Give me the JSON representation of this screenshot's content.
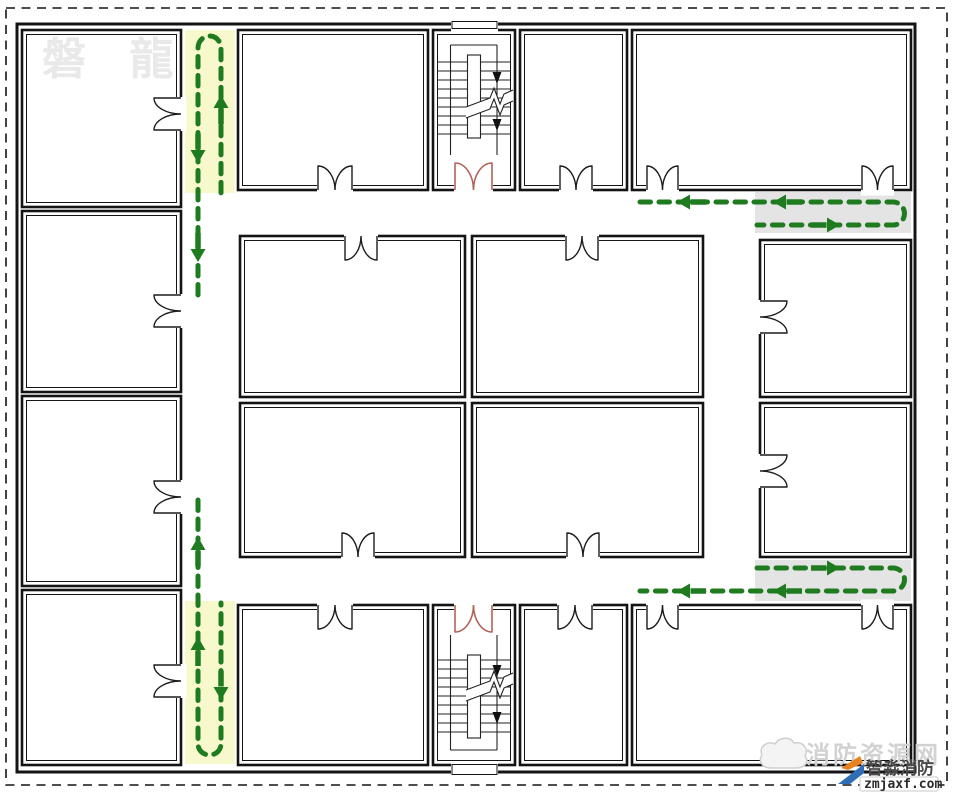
{
  "title": "fire-evacuation-floor-plan",
  "watermarks": {
    "top_left": "磐 龍",
    "site_name": "消防资源网",
    "brand": "智淼消防",
    "domain": "zmjaxf.com"
  },
  "colors": {
    "wall": "#141414",
    "route": "#1e7b1f",
    "corridor_yellow": "#f7f8cc",
    "corridor_gray": "#e4e4e4",
    "door_red": "#b2635a",
    "logo_blue": "#2f6db5",
    "logo_orange": "#e8821e",
    "background": "#ffffff"
  },
  "plan": {
    "canvas": {
      "w": 955,
      "h": 798
    },
    "dashed_border": {
      "x": 6,
      "y": 8,
      "w": 941,
      "h": 777
    },
    "outer_wall": {
      "x": 17,
      "y": 24,
      "w": 898,
      "h": 748
    },
    "highlights": [
      {
        "name": "corridor-highlight-left-top",
        "color": "corridor_yellow",
        "x": 185,
        "y": 30,
        "w": 50,
        "h": 163
      },
      {
        "name": "corridor-highlight-left-bottom",
        "color": "corridor_yellow",
        "x": 185,
        "y": 601,
        "w": 50,
        "h": 163
      },
      {
        "name": "corridor-highlight-right-top",
        "color": "corridor_gray",
        "x": 755,
        "y": 192,
        "w": 156,
        "h": 41
      },
      {
        "name": "corridor-highlight-right-bottom",
        "color": "corridor_gray",
        "x": 755,
        "y": 560,
        "w": 156,
        "h": 41
      }
    ],
    "rooms": [
      {
        "name": "room-left-1",
        "x": 22,
        "y": 30,
        "w": 159,
        "h": 177
      },
      {
        "name": "room-left-2",
        "x": 22,
        "y": 211,
        "w": 159,
        "h": 181
      },
      {
        "name": "room-left-3",
        "x": 22,
        "y": 396,
        "w": 159,
        "h": 190
      },
      {
        "name": "room-left-4",
        "x": 22,
        "y": 590,
        "w": 159,
        "h": 175
      },
      {
        "name": "room-top-1",
        "x": 238,
        "y": 30,
        "w": 190,
        "h": 160
      },
      {
        "name": "stairwell-top",
        "x": 433,
        "y": 30,
        "w": 82,
        "h": 160
      },
      {
        "name": "room-top-2",
        "x": 520,
        "y": 30,
        "w": 107,
        "h": 160
      },
      {
        "name": "room-top-right",
        "x": 632,
        "y": 30,
        "w": 279,
        "h": 160
      },
      {
        "name": "room-center-1",
        "x": 240,
        "y": 236,
        "w": 225,
        "h": 161
      },
      {
        "name": "room-center-2",
        "x": 472,
        "y": 236,
        "w": 231,
        "h": 161
      },
      {
        "name": "room-center-3",
        "x": 240,
        "y": 403,
        "w": 225,
        "h": 154
      },
      {
        "name": "room-center-4",
        "x": 472,
        "y": 403,
        "w": 231,
        "h": 154
      },
      {
        "name": "room-right-1",
        "x": 760,
        "y": 240,
        "w": 151,
        "h": 157
      },
      {
        "name": "room-right-2",
        "x": 760,
        "y": 403,
        "w": 151,
        "h": 154
      },
      {
        "name": "room-bottom-1",
        "x": 238,
        "y": 605,
        "w": 190,
        "h": 160
      },
      {
        "name": "stairwell-bottom",
        "x": 433,
        "y": 605,
        "w": 82,
        "h": 160
      },
      {
        "name": "room-bottom-2",
        "x": 520,
        "y": 605,
        "w": 107,
        "h": 160
      },
      {
        "name": "room-bottom-right",
        "x": 632,
        "y": 605,
        "w": 279,
        "h": 160
      }
    ],
    "exits": [
      {
        "name": "exterior-exit-top",
        "x": 451,
        "y": 19,
        "w": 47,
        "h": 13
      },
      {
        "name": "exterior-exit-bottom",
        "x": 451,
        "y": 762,
        "w": 47,
        "h": 16
      }
    ],
    "stairs": [
      {
        "name": "stair-top",
        "treads": {
          "x1": 437,
          "x2": 511,
          "y0": 62,
          "step": 9,
          "n": 9
        },
        "rails": {
          "xl": 450.5,
          "xr": 497,
          "y1": 45,
          "y2": 155,
          "conn": 45
        },
        "stringer": {
          "x": 467.5,
          "y": 55,
          "w": 13,
          "h": 83
        },
        "break1": [
          [
            466,
            107
          ],
          [
            490,
            98
          ],
          [
            494,
            88
          ],
          [
            500,
            104
          ],
          [
            504,
            94
          ],
          [
            513,
            90
          ]
        ],
        "break2": [
          [
            466,
            118
          ],
          [
            490,
            109
          ],
          [
            494,
            99
          ],
          [
            500,
            115
          ],
          [
            504,
            105
          ],
          [
            513,
            101
          ]
        ],
        "arrows": [
          {
            "x": 497,
            "y": 84
          },
          {
            "x": 497,
            "y": 131
          }
        ]
      },
      {
        "name": "stair-bottom",
        "treads": {
          "x1": 437,
          "x2": 511,
          "y0": 660,
          "step": 9,
          "n": 9
        },
        "rails": {
          "xl": 450.5,
          "xr": 497,
          "y1": 635,
          "y2": 750,
          "conn": 750
        },
        "stringer": {
          "x": 467.5,
          "y": 655,
          "w": 13,
          "h": 83
        },
        "break1": [
          [
            466,
            690
          ],
          [
            490,
            681
          ],
          [
            494,
            671
          ],
          [
            500,
            687
          ],
          [
            504,
            677
          ],
          [
            513,
            673
          ]
        ],
        "break2": [
          [
            466,
            701
          ],
          [
            490,
            692
          ],
          [
            494,
            682
          ],
          [
            500,
            698
          ],
          [
            504,
            688
          ],
          [
            513,
            684
          ]
        ],
        "arrows": [
          {
            "x": 497,
            "y": 677
          },
          {
            "x": 497,
            "y": 724
          }
        ]
      }
    ],
    "doors": [
      {
        "name": "door-room-left-1",
        "orient": "v",
        "wall": 181,
        "a": 98,
        "b": 130,
        "swing": "left"
      },
      {
        "name": "door-room-left-2",
        "orient": "v",
        "wall": 181,
        "a": 295,
        "b": 327,
        "swing": "left"
      },
      {
        "name": "door-room-left-3",
        "orient": "v",
        "wall": 181,
        "a": 481,
        "b": 513,
        "swing": "left"
      },
      {
        "name": "door-room-left-4",
        "orient": "v",
        "wall": 181,
        "a": 665,
        "b": 697,
        "swing": "left"
      },
      {
        "name": "door-room-top-1",
        "orient": "h",
        "wall": 190,
        "a": 318,
        "b": 352,
        "swing": "up"
      },
      {
        "name": "door-stairwell-top",
        "orient": "h",
        "wall": 190,
        "a": 455,
        "b": 492,
        "swing": "up",
        "red": true
      },
      {
        "name": "door-room-top-2",
        "orient": "h",
        "wall": 190,
        "a": 560,
        "b": 592,
        "swing": "up"
      },
      {
        "name": "door-room-top-right-a",
        "orient": "h",
        "wall": 190,
        "a": 647,
        "b": 678,
        "swing": "up"
      },
      {
        "name": "door-room-top-right-b",
        "orient": "h",
        "wall": 190,
        "a": 862,
        "b": 893,
        "swing": "up"
      },
      {
        "name": "door-room-center-1",
        "orient": "h",
        "wall": 236,
        "a": 345,
        "b": 377,
        "swing": "down"
      },
      {
        "name": "door-room-center-2",
        "orient": "h",
        "wall": 236,
        "a": 566,
        "b": 598,
        "swing": "down"
      },
      {
        "name": "door-room-center-3",
        "orient": "h",
        "wall": 557,
        "a": 342,
        "b": 374,
        "swing": "up"
      },
      {
        "name": "door-room-center-4",
        "orient": "h",
        "wall": 557,
        "a": 567,
        "b": 599,
        "swing": "up"
      },
      {
        "name": "door-room-right-1",
        "orient": "v",
        "wall": 760,
        "a": 301,
        "b": 333,
        "swing": "right"
      },
      {
        "name": "door-room-right-2",
        "orient": "v",
        "wall": 760,
        "a": 455,
        "b": 487,
        "swing": "right"
      },
      {
        "name": "door-room-bottom-1",
        "orient": "h",
        "wall": 605,
        "a": 318,
        "b": 352,
        "swing": "down"
      },
      {
        "name": "door-stairwell-bottom",
        "orient": "h",
        "wall": 605,
        "a": 455,
        "b": 492,
        "swing": "down",
        "red": true
      },
      {
        "name": "door-room-bottom-2",
        "orient": "h",
        "wall": 605,
        "a": 558,
        "b": 592,
        "swing": "down"
      },
      {
        "name": "door-room-bottom-right-a",
        "orient": "h",
        "wall": 605,
        "a": 647,
        "b": 678,
        "swing": "down"
      },
      {
        "name": "door-room-bottom-right-b",
        "orient": "h",
        "wall": 605,
        "a": 862,
        "b": 893,
        "swing": "down"
      }
    ],
    "routes": [
      {
        "name": "evacuation-route-left-corridor-top",
        "d": "M 198 295 L 198 48 A 11.5 12 0 0 1 221 48 L 221 193"
      },
      {
        "name": "evacuation-route-left-corridor-bottom",
        "d": "M 198 500 L 198 744 A 11.5 11 0 0 0 221 744 L 221 603"
      },
      {
        "name": "evacuation-route-right-corridor-top",
        "d": "M 640 202 L 893 202 A 11.5 11.5 0 0 1 893 225 L 757 225"
      },
      {
        "name": "evacuation-route-right-corridor-bottom",
        "d": "M 757 568 L 893 568 A 11.5 11.5 0 0 1 893 591 L 640 591"
      }
    ],
    "route_arrows": [
      {
        "x": 198,
        "y": 163,
        "d": "down"
      },
      {
        "x": 221,
        "y": 95,
        "d": "up"
      },
      {
        "x": 198,
        "y": 262,
        "d": "down"
      },
      {
        "x": 198,
        "y": 537,
        "d": "up"
      },
      {
        "x": 198,
        "y": 637,
        "d": "up"
      },
      {
        "x": 221,
        "y": 700,
        "d": "down"
      },
      {
        "x": 677,
        "y": 202,
        "d": "left"
      },
      {
        "x": 773,
        "y": 202,
        "d": "left"
      },
      {
        "x": 840,
        "y": 225,
        "d": "right"
      },
      {
        "x": 840,
        "y": 568,
        "d": "right"
      },
      {
        "x": 677,
        "y": 591,
        "d": "left"
      },
      {
        "x": 773,
        "y": 591,
        "d": "left"
      }
    ]
  }
}
